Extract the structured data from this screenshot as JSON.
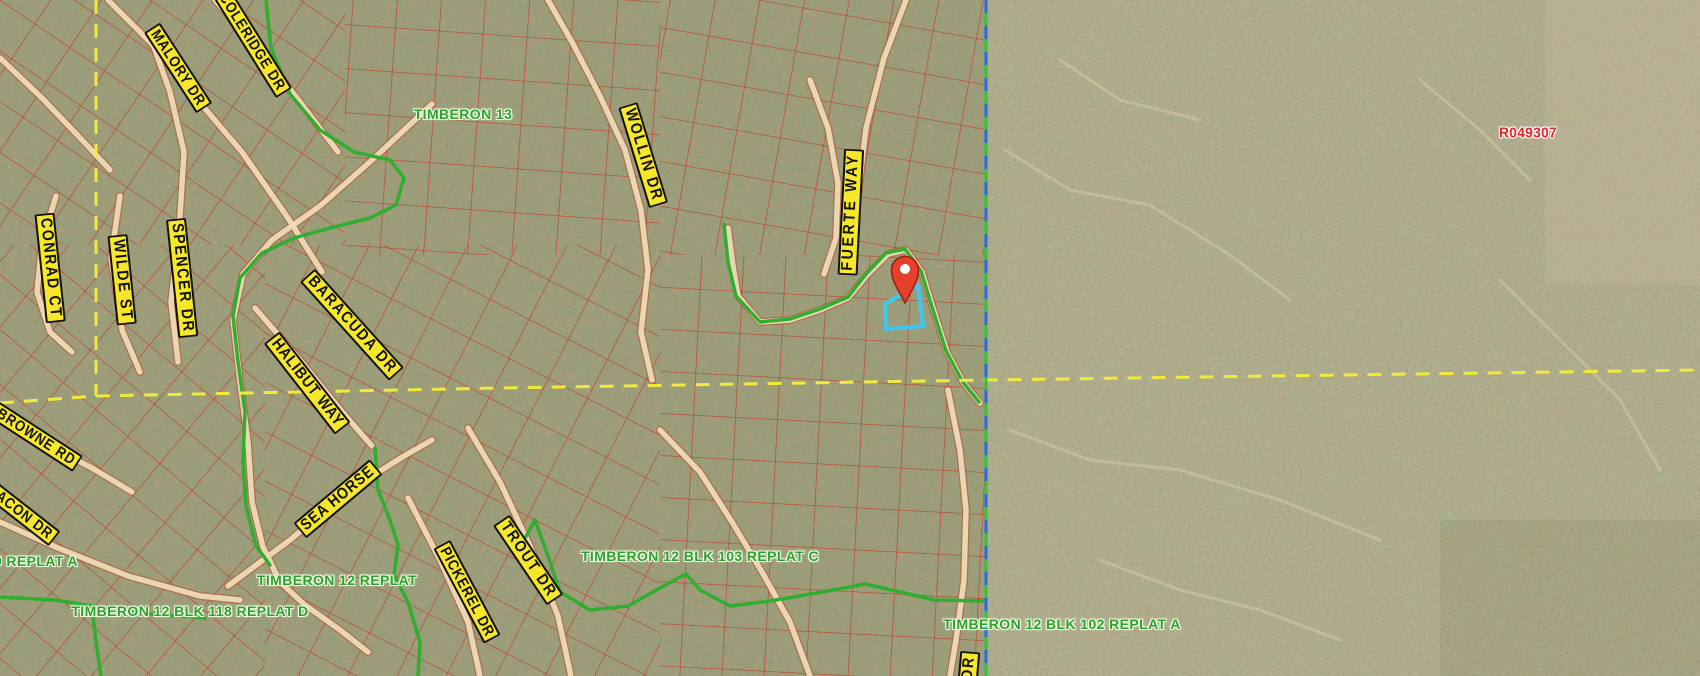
{
  "map": {
    "colors": {
      "terrain_left": "#ac9e7b",
      "terrain_right": "#b7aa88",
      "parcel_line": "#c8271c",
      "road_fill": "#ecdcb8",
      "road_casing": "#bb4a2e",
      "subdivision_boundary": "#2fae2f",
      "section_line": "#f2e93d",
      "county_line_blue": "#2e6fd6",
      "county_line_green": "#35c53c",
      "selected_parcel": "#3ec7f0",
      "pin_fill": "#e6402a",
      "pin_stroke": "#9c2013",
      "street_label_bg": "#f6e72a",
      "street_label_text": "#111111",
      "subdivision_label_text": "#2f9e33",
      "parcel_id_text": "#e3262c"
    },
    "street_labels": [
      {
        "text": "MALORY DR",
        "x": 178,
        "y": 68,
        "rot": 57,
        "size": 15,
        "ls": 1
      },
      {
        "text": "COLERIDGE DR",
        "x": 252,
        "y": 42,
        "rot": 58,
        "size": 15,
        "ls": 1
      },
      {
        "text": "CONRAD CT",
        "x": 50,
        "y": 268,
        "rot": 84,
        "size": 16,
        "ls": 2
      },
      {
        "text": "WILDE ST",
        "x": 122,
        "y": 280,
        "rot": 84,
        "size": 16,
        "ls": 2
      },
      {
        "text": "SPENCER DR",
        "x": 182,
        "y": 278,
        "rot": 84,
        "size": 16,
        "ls": 2
      },
      {
        "text": "BARACUDA DR",
        "x": 352,
        "y": 325,
        "rot": 48,
        "size": 16,
        "ls": 2
      },
      {
        "text": "HALIBUT WAY",
        "x": 307,
        "y": 383,
        "rot": 52,
        "size": 16,
        "ls": 1
      },
      {
        "text": "SEA HORSE",
        "x": 338,
        "y": 499,
        "rot": -40,
        "size": 16,
        "ls": 1
      },
      {
        "text": "TROUT DR",
        "x": 528,
        "y": 560,
        "rot": 56,
        "size": 16,
        "ls": 2
      },
      {
        "text": "PICKEREL DR",
        "x": 467,
        "y": 592,
        "rot": 62,
        "size": 15,
        "ls": 1
      },
      {
        "text": "WOLLIN DR",
        "x": 643,
        "y": 155,
        "rot": 73,
        "size": 16,
        "ls": 2
      },
      {
        "text": "FUERTE WAY",
        "x": 851,
        "y": 212,
        "rot": -87,
        "size": 16,
        "ls": 3
      },
      {
        "text": "BROWNE RD",
        "x": 36,
        "y": 437,
        "rot": 33,
        "size": 15,
        "ls": 1
      },
      {
        "text": "BACON DR",
        "x": 20,
        "y": 512,
        "rot": 38,
        "size": 15,
        "ls": 1
      },
      {
        "text": "DR",
        "x": 969,
        "y": 668,
        "rot": -85,
        "size": 16,
        "ls": 2
      }
    ],
    "subdivision_labels": [
      {
        "text": "TIMBERON 13",
        "x": 463,
        "y": 114
      },
      {
        "text": "TIMBERON 12 BLK 103 REPLAT C",
        "x": 700,
        "y": 556
      },
      {
        "text": "TIMBERON 12 REPLAT",
        "x": 337,
        "y": 580
      },
      {
        "text": "TIMBERON 12 BLK 118 REPLAT D",
        "x": 190,
        "y": 611
      },
      {
        "text": "TIMBERON 12 BLK 102 REPLAT A",
        "x": 1062,
        "y": 624
      },
      {
        "text": "0 REPLAT A",
        "x": 36,
        "y": 561
      }
    ],
    "parcel_id_label": {
      "text": "R049307",
      "x": 1528,
      "y": 133
    },
    "marker": {
      "x": 905,
      "y": 270,
      "tip_y": 303,
      "radius": 13.5
    },
    "selected_parcel": {
      "points": "885,304 918,285 923,326 886,329"
    },
    "section_lines": {
      "vertical": "96,0 96,396",
      "horizontal": "0,403 96,396 500,388 986,380 1700,370"
    },
    "county_boundary_x": 986,
    "green_boundaries": [
      "266,0 271,48 290,94 320,130 354,152 390,160 404,178 396,205 370,218 330,228 294,238 262,253 240,278 233,316 238,362 245,412 243,462 246,506 256,546 270,565",
      "375,448 378,490 390,520 398,545 394,575 408,602 420,642 418,676",
      "515,556 535,520 548,556 560,592 590,610 628,606 660,588 686,574",
      "686,574 700,590 730,606 770,601 822,592 865,584 900,592 935,600 984,601",
      "724,224 728,262 736,296 760,322 790,319 820,309 848,297 866,274 886,253 905,249 921,271 931,304 946,351 962,381 979,402",
      "0,597 55,600 92,606 96,642 101,676",
      "92,606 150,614 205,618"
    ],
    "roads": [
      "108,0 150,42 196,98 242,152 288,218 322,272",
      "215,0 256,46 300,102 338,152",
      "0,58 42,98 84,142 110,170",
      "120,196 111,258 122,330 140,372",
      "150,36 170,92 184,152 179,232 171,302 178,362",
      "56,196 42,242 37,292 50,332 72,352",
      "432,104 372,160 320,206 272,240 243,274 233,320 240,382 248,442 252,502 263,547 280,582 305,605 340,630 368,652",
      "255,308 300,360 344,414 372,446",
      "228,586 290,540 350,490 404,456 432,440",
      "468,428 500,482 530,546 558,616 571,676",
      "408,498 440,560 468,622 480,676",
      "548,0 572,42 600,96 625,150 641,210 648,270 641,332 652,380",
      "810,80 828,128 838,183 836,238 824,274",
      "728,228 733,266 738,296 760,322 790,320 820,310 848,298 868,274 888,254 906,250 922,272 932,305 947,352 963,382 980,403",
      "906,0 884,58 866,128 858,196 852,246",
      "660,430 700,472 732,522 762,572 790,622 810,676",
      "0,418 45,444 92,468 132,492",
      "0,522 58,548 128,576 200,596 240,600",
      "948,390 960,450 966,510 964,580 956,640 950,676"
    ],
    "parcel_patches": [
      {
        "x": 0,
        "y": 0,
        "w": 345,
        "h": 245,
        "angle": 34,
        "cell": 42
      },
      {
        "x": 0,
        "y": 245,
        "w": 265,
        "h": 431,
        "angle": 40,
        "cell": 42
      },
      {
        "x": 345,
        "y": 0,
        "w": 315,
        "h": 255,
        "angle": 4,
        "cell": 44
      },
      {
        "x": 660,
        "y": 0,
        "w": 326,
        "h": 255,
        "angle": 10,
        "cell": 44
      },
      {
        "x": 265,
        "y": 245,
        "w": 395,
        "h": 431,
        "angle": 27,
        "cell": 44
      },
      {
        "x": 660,
        "y": 255,
        "w": 326,
        "h": 421,
        "angle": 3,
        "cell": 42
      }
    ],
    "desert_washes": [
      "1005,150 1070,190 1150,205 1230,255 1290,300",
      "1010,430 1090,460 1180,470 1280,500 1380,540",
      "1500,280 1560,340 1620,400 1660,470",
      "1100,560 1180,590 1260,610 1340,640",
      "1420,80 1480,130 1530,180",
      "1060,60 1120,100 1200,120"
    ]
  }
}
